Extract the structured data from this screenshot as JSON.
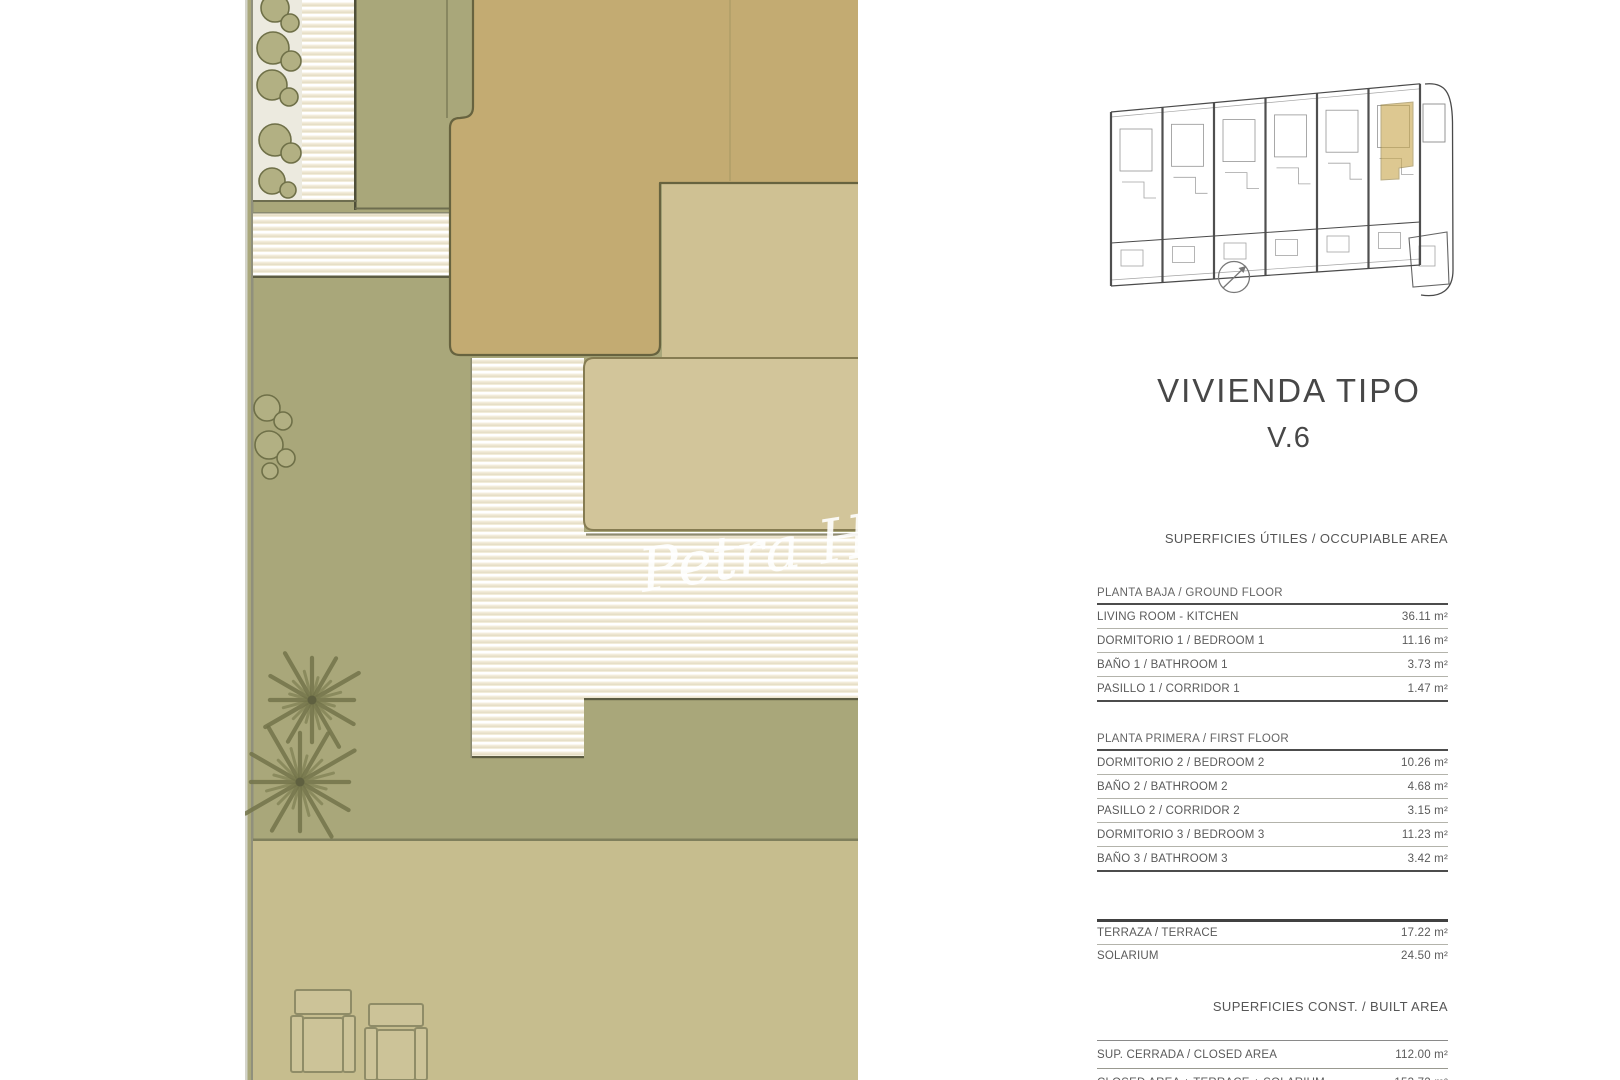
{
  "panel": {
    "title": "VIVIENDA TIPO",
    "subtitle": "V.6"
  },
  "watermark": {
    "text": "Petra H"
  },
  "areas": {
    "occupiable_header": "SUPERFICIES ÚTILES / OCCUPIABLE AREA",
    "built_header": "SUPERFICIES CONST. / BUILT AREA",
    "unit_label": "m²",
    "sections": [
      {
        "id": "ground",
        "label": "PLANTA BAJA / GROUND FLOOR",
        "rows": [
          {
            "label": "LIVING ROOM - KITCHEN",
            "value": "36.11 m²"
          },
          {
            "label": "DORMITORIO 1 /  BEDROOM 1",
            "value": "11.16 m²"
          },
          {
            "label": "BAÑO 1 / BATHROOM 1",
            "value": "3.73 m²"
          },
          {
            "label": "PASILLO 1 / CORRIDOR 1",
            "value": "1.47 m²"
          }
        ]
      },
      {
        "id": "first",
        "label": "PLANTA PRIMERA / FIRST FLOOR",
        "rows": [
          {
            "label": "DORMITORIO 2 / BEDROOM 2",
            "value": "10.26 m²"
          },
          {
            "label": "BAÑO 2 / BATHROOM 2",
            "value": "4.68 m²"
          },
          {
            "label": "PASILLO 2 / CORRIDOR 2",
            "value": "3.15 m²"
          },
          {
            "label": "DORMITORIO 3 / BEDROOM 3",
            "value": "11.23 m²"
          },
          {
            "label": "BAÑO 3 / BATHROOM 3",
            "value": "3.42 m²"
          }
        ]
      },
      {
        "id": "terrace",
        "label": null,
        "rows": [
          {
            "label": "TERRAZA / TERRACE",
            "value": "17.22 m²"
          },
          {
            "label": "SOLARIUM",
            "value": "24.50 m²"
          }
        ]
      },
      {
        "id": "built",
        "label": null,
        "rows": [
          {
            "label": "SUP. CERRADA / CLOSED AREA",
            "value": "112.00 m²"
          },
          {
            "label": "CLOSED AREA + TERRACE + SOLARIUM",
            "value": "153.72 m²"
          }
        ]
      }
    ]
  },
  "colors": {
    "grass": "#a9a77a",
    "roof_dark": "#c3ab72",
    "roof_light": "#cfc193",
    "solarium_roof": "#d2c59a",
    "paving": "#c6bd8e",
    "hatch_base": "#f2ecda",
    "highlight_unit": "#c9a84e",
    "line_dark": "#55553a",
    "text": "#5a5a5a"
  }
}
